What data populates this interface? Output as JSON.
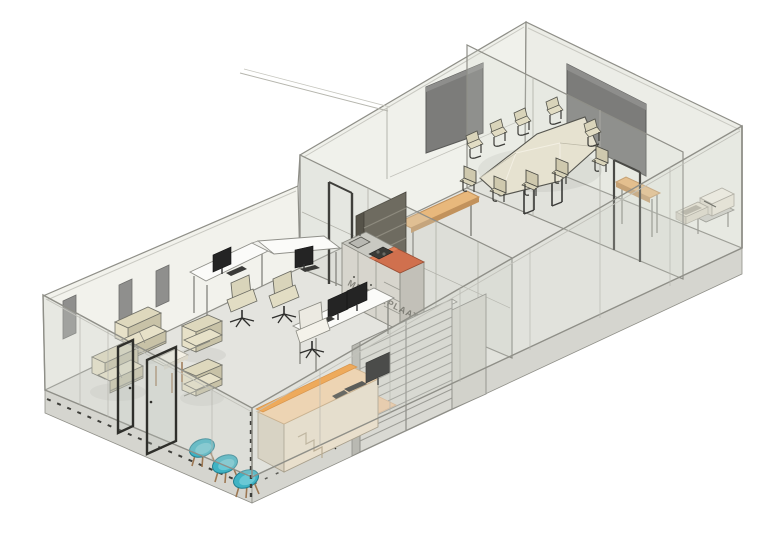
{
  "meta": {
    "view_type": "3d-isometric-office-interior-render",
    "background": "#ffffff"
  },
  "kitchen": {
    "watermark": "MEUBELPLAAT"
  },
  "colors": {
    "line": "#8f8f88",
    "line-dark": "#55554f",
    "wall": "#f2f2ec",
    "wall-meeting": "#f0f1eb",
    "wall-ne": "#ecede7",
    "glass": "rgba(205,210,202,0.30)",
    "glass-light": "rgba(214,218,210,0.22)",
    "floor": "#e4e4df",
    "slab": "#d5d5cf",
    "panel-gray": "#8f8f8d",
    "screen-dark": "#7c7c7a",
    "sofa": "#ded8bd",
    "sofa-top": "#e7e1c8",
    "sofa-shade": "#c8c2a7",
    "conf-table": "#e6e2d0",
    "chair-beige": "#d9d4ba",
    "chair-shade": "#cfc9ae",
    "chair-white": "#eceae2",
    "desk-white": "#fbfbf9",
    "wood": "#e8b87c",
    "wood-dark": "#c2925c",
    "counter-orange": "#d0704e",
    "counter-orange-light": "#e28058",
    "accent-orange": "#f59d3a",
    "desk-peach": "#f4d2ab",
    "desk-peach-front": "#e9dfcc",
    "desk-peach-side": "#d9d1c0",
    "mat-peach": "#eccaa6",
    "teal": "#3fb3c4",
    "teal-dark": "#237f90",
    "teal-light": "#6ac8d5",
    "leg-wood": "#9c7752",
    "monitor": "#242424",
    "metal": "#8c8c86",
    "cabinet": "#d7d5cd",
    "cabinet-shade": "#c2c0b8",
    "shelf-dark": "#6e6b60",
    "shelf-side": "#565349",
    "locker": "#d9d9d3",
    "locker-slat": "#9c9c96",
    "locker-side": "#b9b9b2",
    "frame-dark": "#2f2f2b",
    "dash-dark": "#3e3e3a"
  }
}
